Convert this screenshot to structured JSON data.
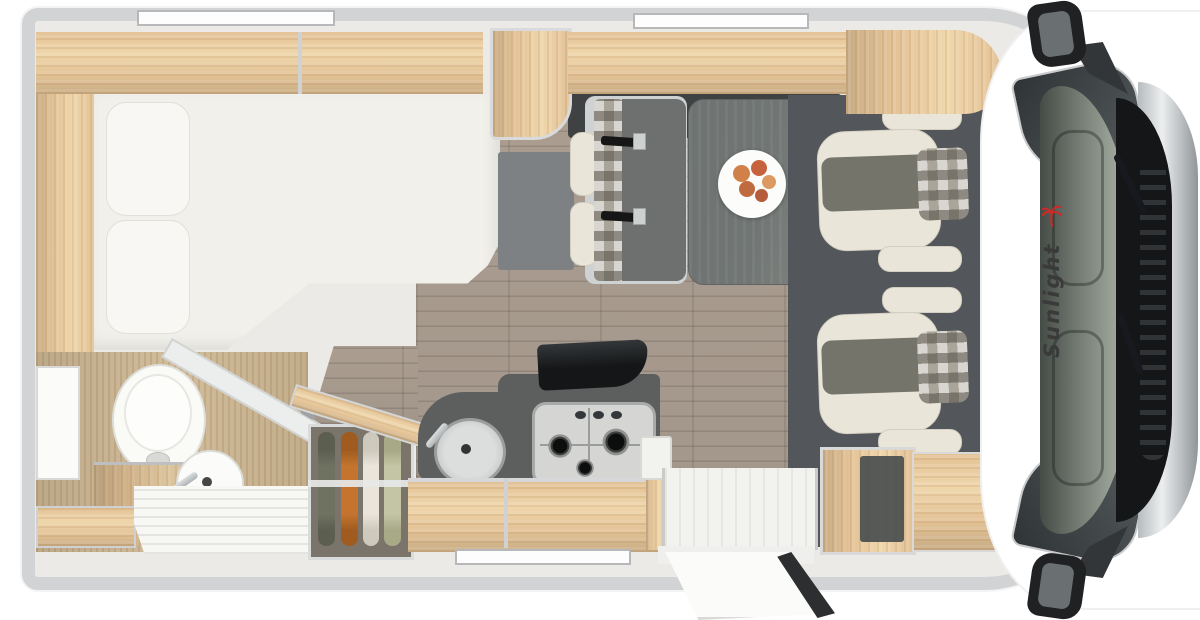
{
  "brand": {
    "logo_text": "Sunlight",
    "logo_color": "#3a3a3a",
    "logo_icon": "palm-sun-icon",
    "logo_icon_color": "#cf2a27"
  },
  "plan": {
    "view": "top-down motorhome floor plan",
    "zones": [
      "rear-bed",
      "bathroom",
      "wardrobe",
      "kitchen",
      "dinette",
      "entry-door",
      "cab-with-swivel-seats"
    ],
    "fixtures": [
      "pillows",
      "mirror",
      "toilet",
      "washbasin",
      "shower-tray",
      "hanging-clothes",
      "round-sink",
      "3-burner-hob",
      "open-hob-lid",
      "dinette-bench-with-seatbelts",
      "table",
      "fruit-plate",
      "two-cab-seats",
      "open-entry-door",
      "side-mirrors",
      "windshield-with-wipers"
    ],
    "window_count": 3
  },
  "palette": {
    "wall": "#d2d3d4",
    "wood": "#e3c296",
    "wood_dark": "#c9ac84",
    "wood_floor": "#a2958a",
    "counter_dark": "#5d5f5e",
    "cab_floor": "#53565a",
    "mattress": "#f1f0ea",
    "seat_cream": "#e9e5d8",
    "seat_gray": "#75746b",
    "table": "#717674",
    "steel": "#c7c9c8",
    "glass": "#7a8178",
    "black": "#141617",
    "chrome": "#c3c7ca",
    "logo": "#3a3a3a",
    "logo_red": "#cf2a27",
    "cloth_olive": "#6f7261",
    "cloth_orange": "#c4742e",
    "cloth_cream": "#e9e5da",
    "cloth_sage": "#c3c5a5",
    "fruit": "#d2804a"
  }
}
